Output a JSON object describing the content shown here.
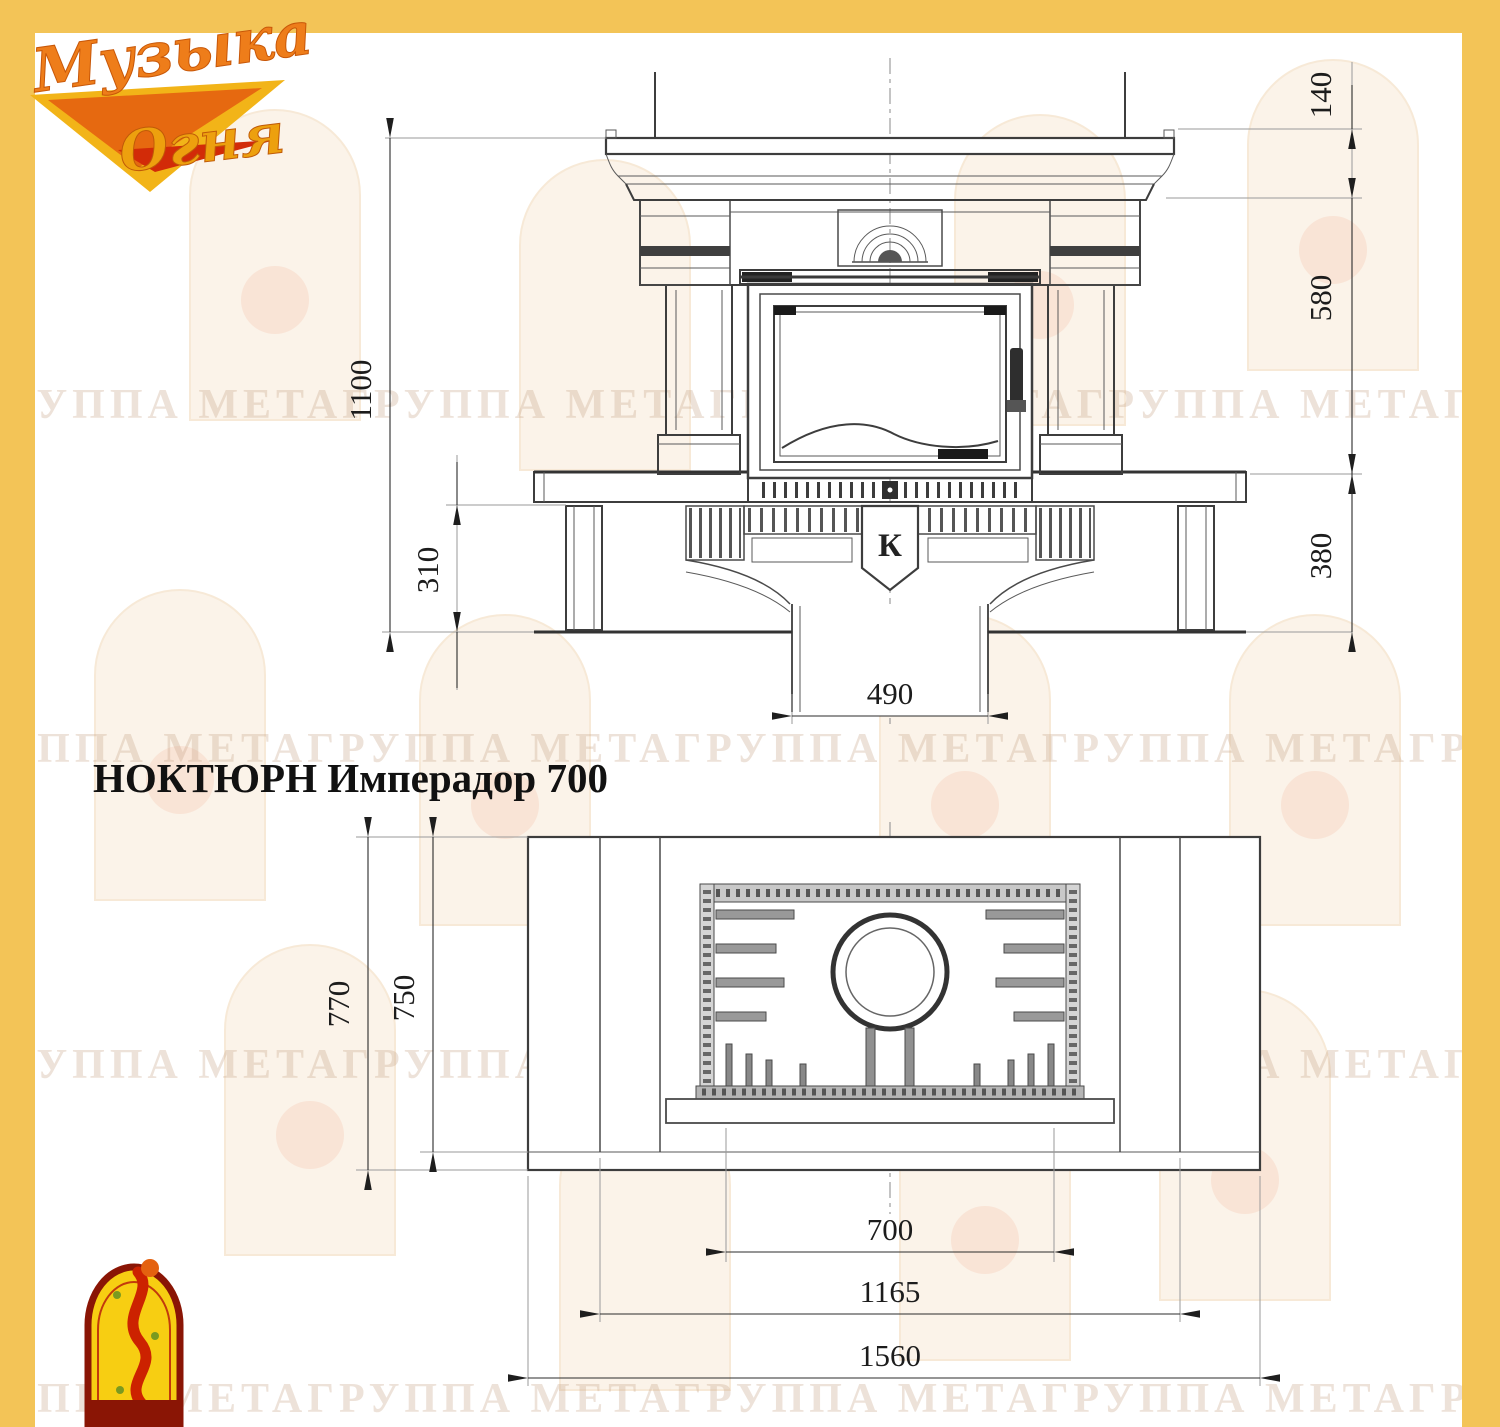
{
  "page": {
    "title": "НОКТЮРН Имперадор 700"
  },
  "brand": {
    "logo_line1": "Музыка",
    "logo_line2": "Огня",
    "colors": {
      "frame_yellow": "#F3C457",
      "logo_orange": "#EE7D1A",
      "logo_gold": "#F2B418",
      "logo_red": "#D22B08",
      "arch_logo_border": "#8A1505",
      "arch_logo_fill": "#F7CE12"
    }
  },
  "watermark": {
    "text": "ГРУППА МЕТАГРУППА МЕТАГРУППА МЕТАГРУППА МЕТАГРУППА МЕТА"
  },
  "front_view": {
    "label": "front elevation of fireplace",
    "emblem_letter": "К",
    "dims": {
      "total_height": "1100",
      "plinth_height": "310",
      "flue_width": "490",
      "mantel_height": "140",
      "portal_height": "580",
      "podium_height": "380"
    }
  },
  "plan_view": {
    "label": "top plan view of fireplace",
    "dims": {
      "total_depth": "770",
      "body_depth": "750",
      "firebox_width": "700",
      "portal_width": "1165",
      "total_width": "1560"
    }
  }
}
